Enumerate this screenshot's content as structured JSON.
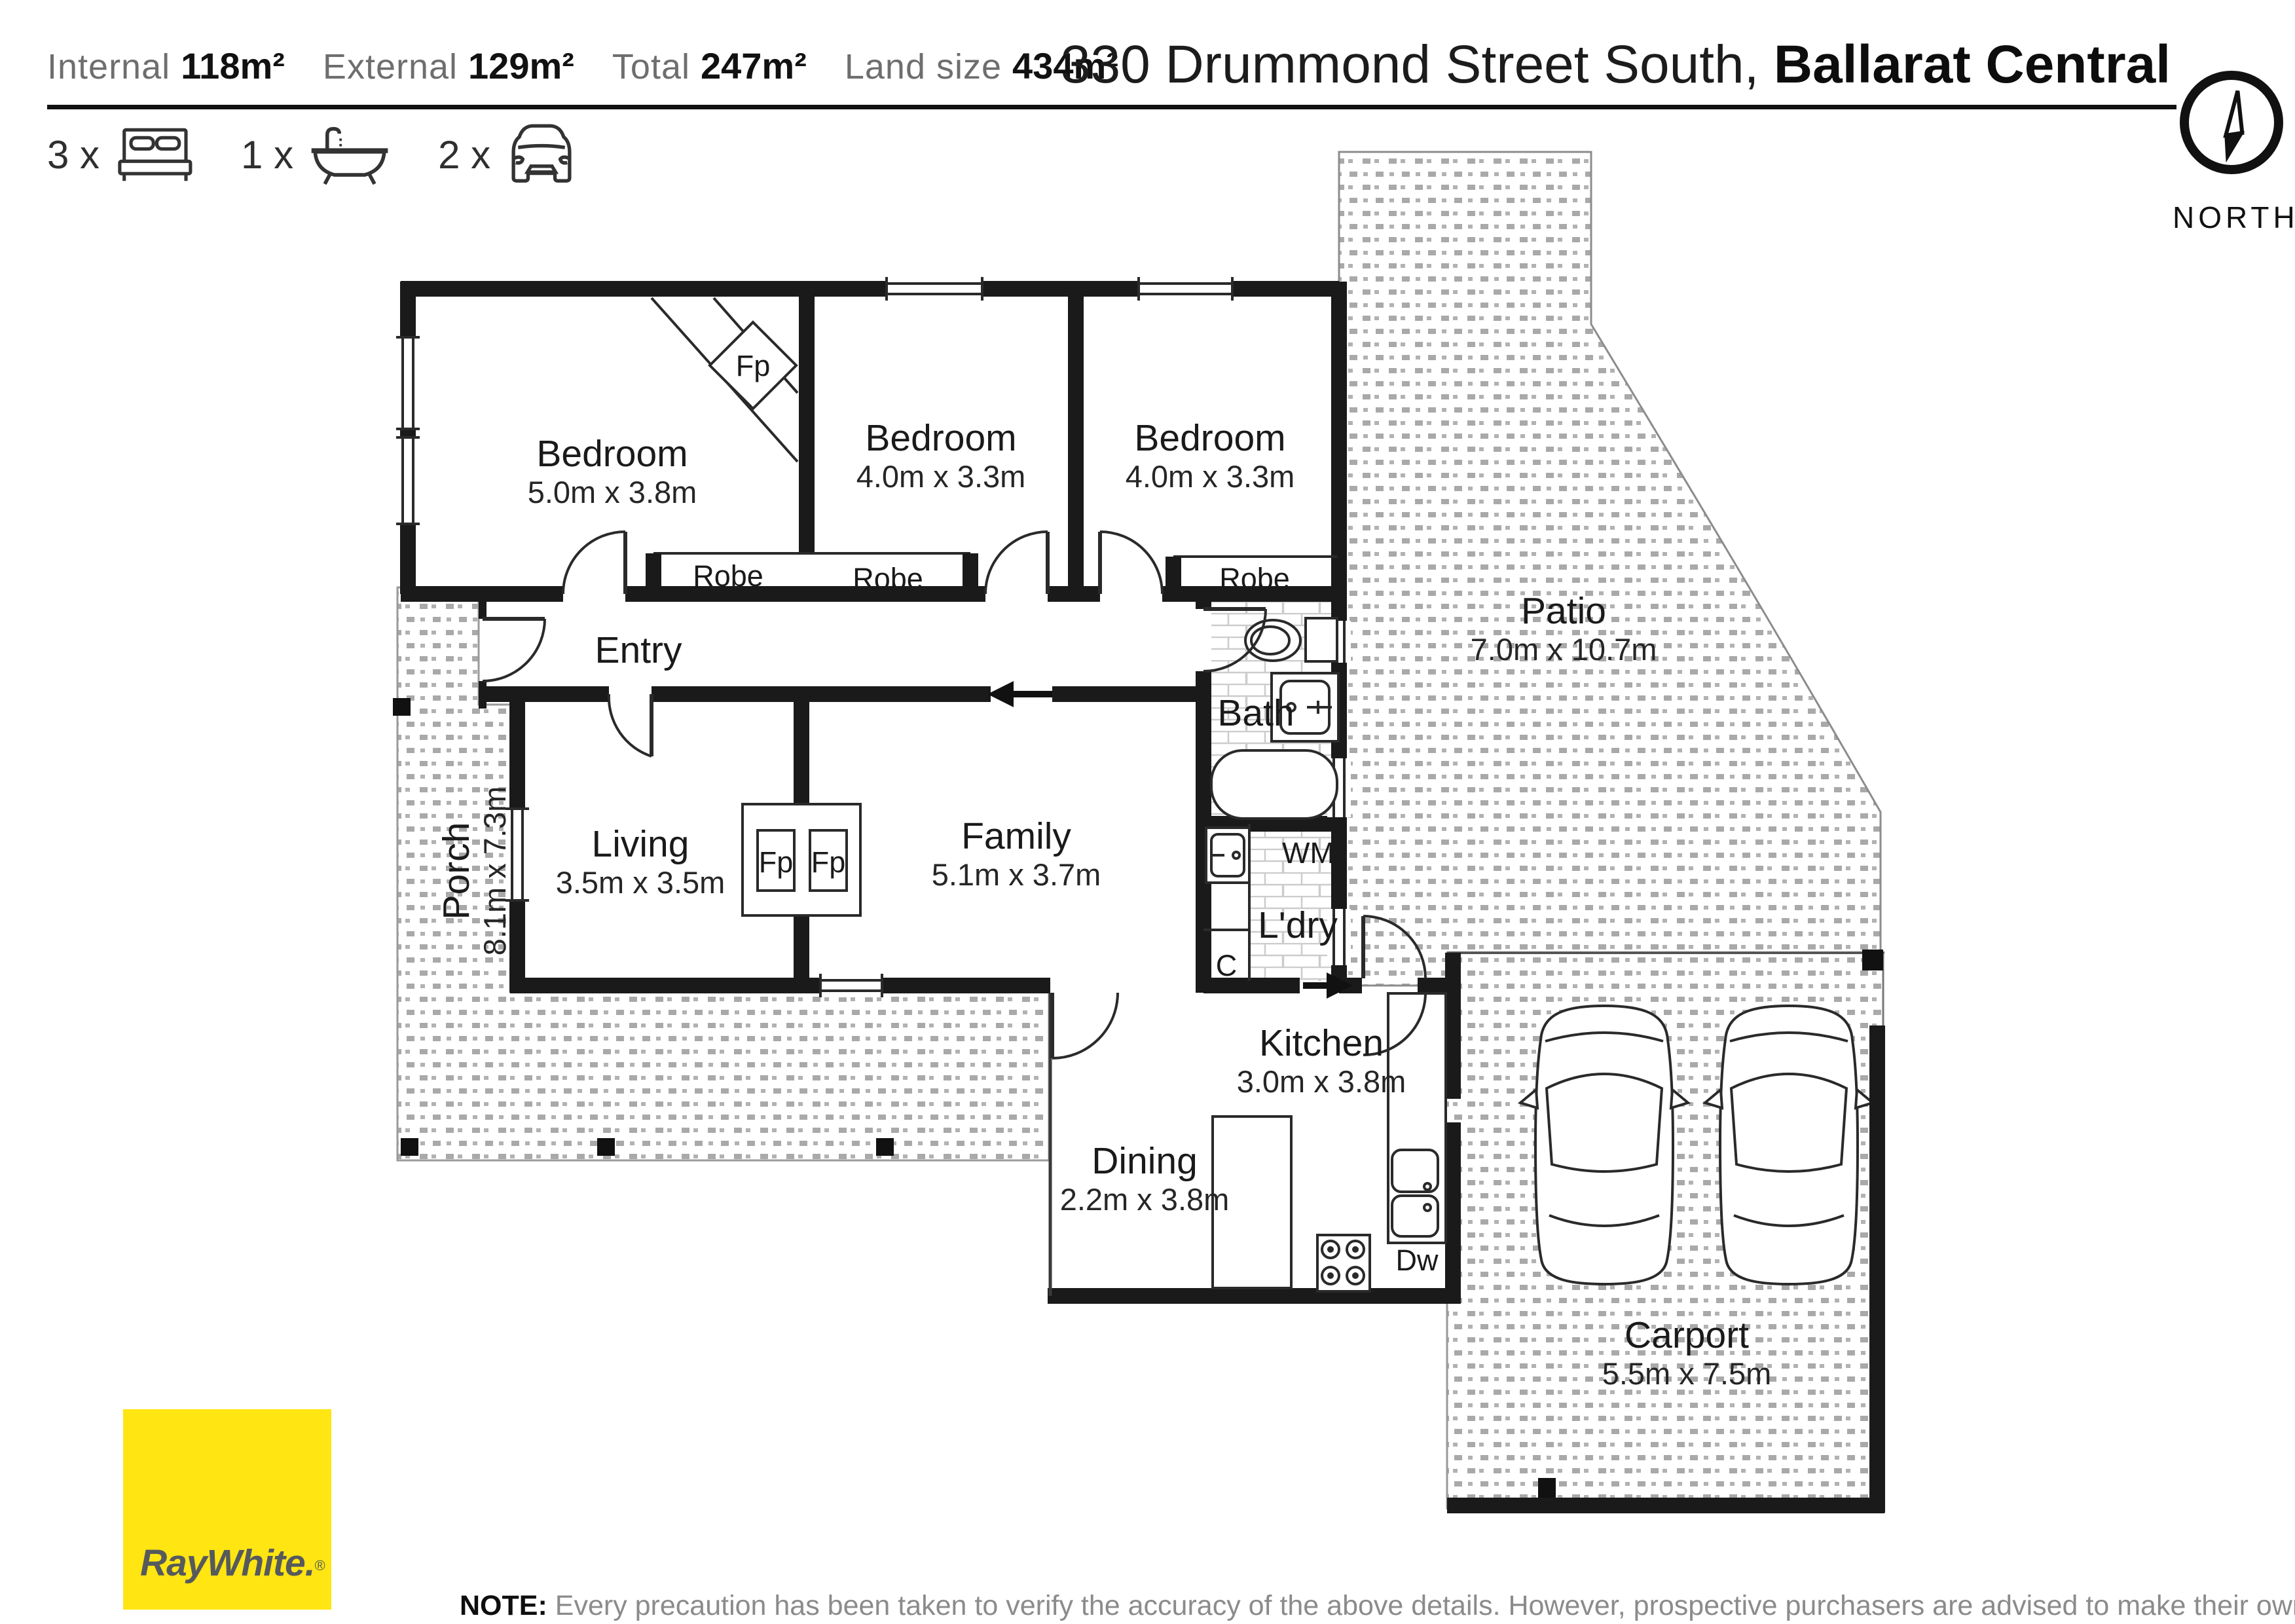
{
  "header": {
    "stats": [
      {
        "label": "Internal",
        "value": "118m²"
      },
      {
        "label": "External",
        "value": "129m²"
      },
      {
        "label": "Total",
        "value": "247m²"
      },
      {
        "label": "Land size",
        "value": "434m²"
      }
    ],
    "title": {
      "street": "330 Drummond Street South,",
      "suburb": "Ballarat Central"
    },
    "features": [
      {
        "count": "3 x",
        "icon": "bed-icon"
      },
      {
        "count": "1 x",
        "icon": "bath-icon"
      },
      {
        "count": "2 x",
        "icon": "car-icon"
      }
    ],
    "compass": {
      "label": "NORTH"
    }
  },
  "plan": {
    "rooms": {
      "bedroom1": {
        "name": "Bedroom",
        "dims": "5.0m x 3.8m"
      },
      "bedroom2": {
        "name": "Bedroom",
        "dims": "4.0m x 3.3m"
      },
      "bedroom3": {
        "name": "Bedroom",
        "dims": "4.0m x 3.3m"
      },
      "entry": {
        "name": "Entry"
      },
      "bath": {
        "name": "Bath"
      },
      "living": {
        "name": "Living",
        "dims": "3.5m x 3.5m"
      },
      "family": {
        "name": "Family",
        "dims": "5.1m x 3.7m"
      },
      "laundry": {
        "name": "L'dry"
      },
      "kitchen": {
        "name": "Kitchen",
        "dims": "3.0m x 3.8m"
      },
      "dining": {
        "name": "Dining",
        "dims": "2.2m x 3.8m"
      },
      "porch": {
        "name": "Porch",
        "dims": "8.1m x 7.3m"
      },
      "patio": {
        "name": "Patio",
        "dims": "7.0m x 10.7m"
      },
      "carport": {
        "name": "Carport",
        "dims": "5.5m x 7.5m"
      }
    },
    "labels": {
      "robe": "Robe",
      "fp": "Fp",
      "wm": "WM",
      "cupboard": "C",
      "dishwasher": "Dw"
    }
  },
  "footer": {
    "brand": {
      "name": "RayWhite.",
      "reg": "®"
    },
    "note_prefix": "NOTE:",
    "note_text": "Every precaution has been taken to verify the accuracy of the above details. However, prospective purchasers are advised to make their own enquiries."
  },
  "colors": {
    "brand_yellow": "#FFE512",
    "brand_text": "#565A5C",
    "wall": "#1a1a1a"
  }
}
